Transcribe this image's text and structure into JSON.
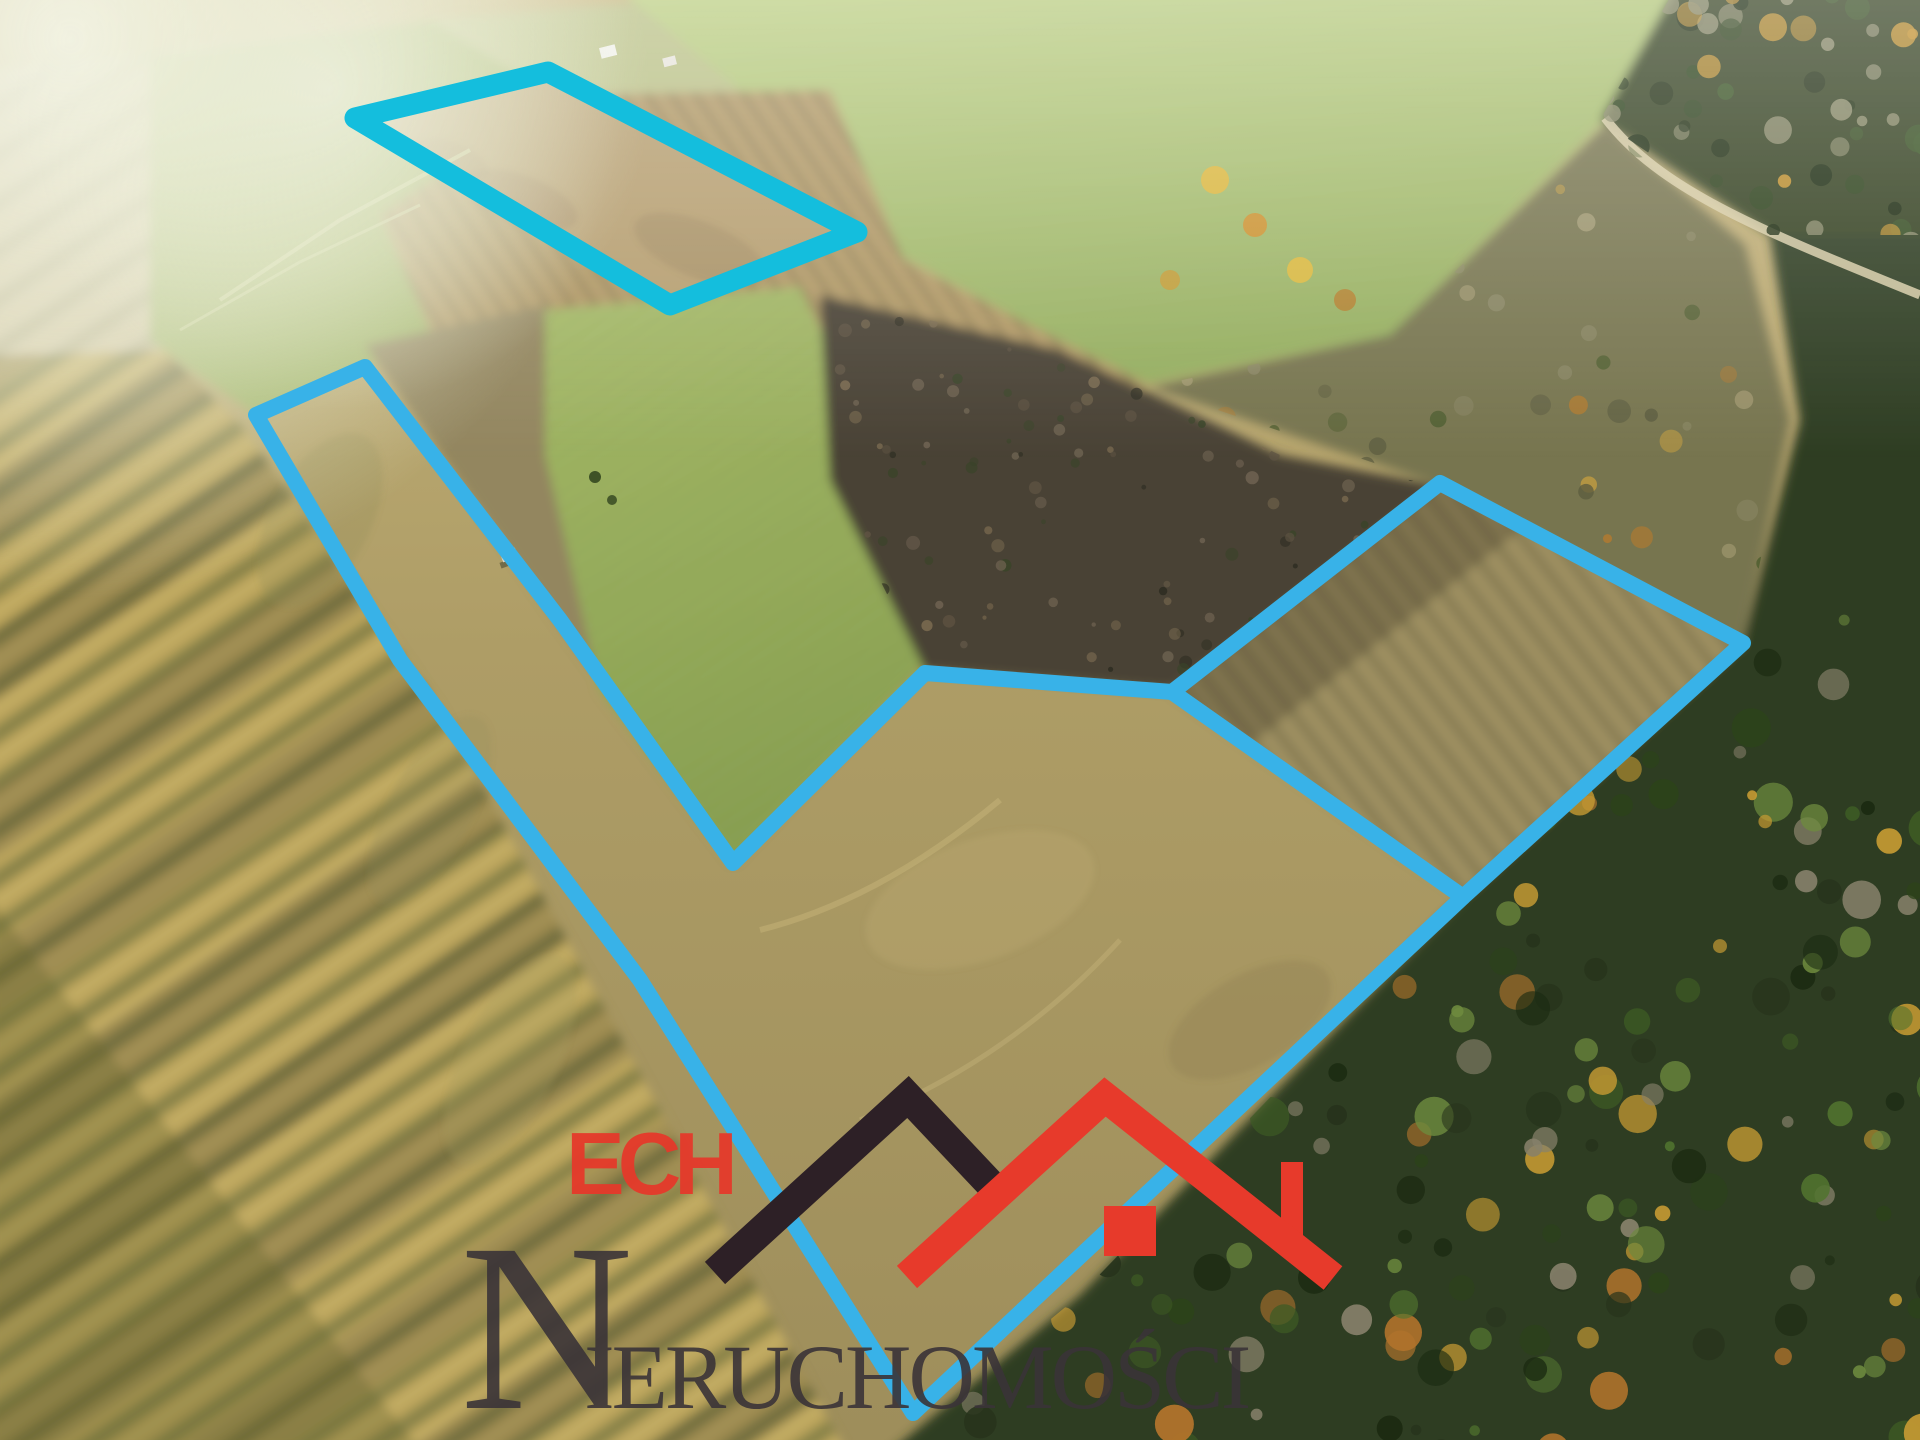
{
  "watermark": {
    "line1": "ECH",
    "line2_initial": "N",
    "line2_rest": "IERUCHOMOŚCI",
    "text_red": "#e5392b",
    "text_dark": "#3a3438",
    "roof_dark": "#2d2026",
    "roof_red": "#e73a2b",
    "chimney_red": "#e73a2b"
  },
  "overlay": {
    "accent_cyan": "#38b2e8",
    "accent_cyan_bright": "#14bedd",
    "parcels": [
      {
        "name": "parcel-north",
        "points": "355,118 548,72 857,232 670,305",
        "stroke": "#14bedd",
        "stroke_width": 21
      },
      {
        "name": "parcel-main",
        "points": "256,415 365,367 560,620 733,863 925,673 1172,692 1463,897 913,1413 640,980 400,660",
        "stroke": "#38b2e8",
        "stroke_width": 16
      },
      {
        "name": "parcel-east",
        "points": "1172,692 1440,483 1743,643 1463,897",
        "stroke": "#38b2e8",
        "stroke_width": 16
      }
    ]
  }
}
